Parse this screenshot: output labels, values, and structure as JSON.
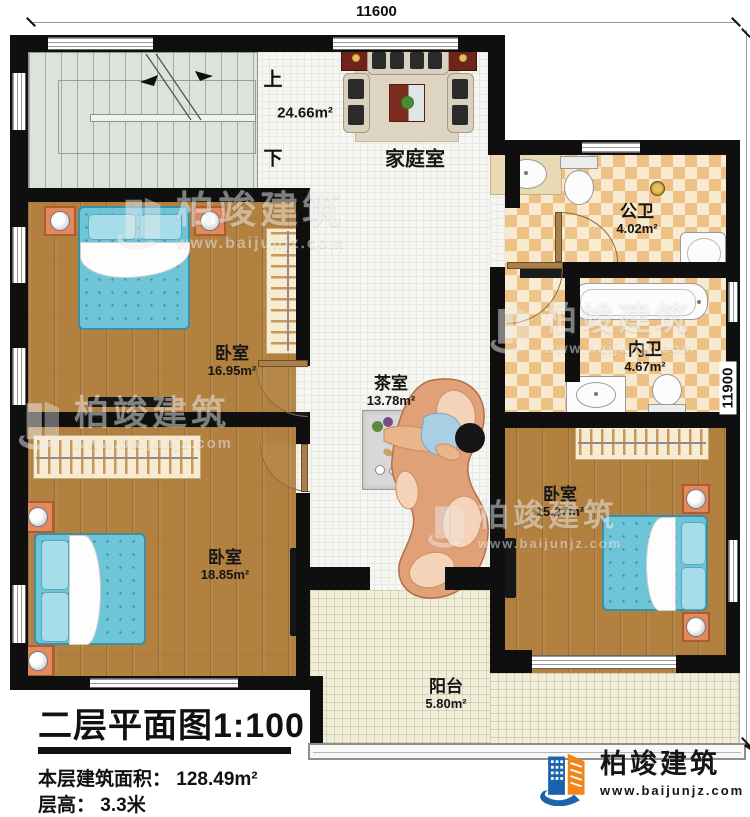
{
  "plan": {
    "dimensions": {
      "top": "11600",
      "right": "11900"
    },
    "stairs": {
      "up": "上",
      "down": "下"
    },
    "rooms": {
      "family": {
        "name": "家庭室",
        "area": "24.66m²"
      },
      "public_bath": {
        "name": "公卫",
        "area": "4.02m²"
      },
      "ensuite_bath": {
        "name": "内卫",
        "area": "4.67m²"
      },
      "bedroom1": {
        "name": "卧室",
        "area": "16.95m²"
      },
      "tea": {
        "name": "茶室",
        "area": "13.78m²"
      },
      "bedroom2": {
        "name": "卧室",
        "area": "18.85m²"
      },
      "bedroom3": {
        "name": "卧室",
        "area": "15.27m²"
      },
      "balcony": {
        "name": "阳台",
        "area": "5.80m²"
      }
    }
  },
  "title_block": {
    "title": "二层平面图",
    "scale": "1:100",
    "area_label": "本层建筑面积：",
    "area_value": "128.49m²",
    "floor_height_label": "层高：",
    "floor_height_value": "3.3米"
  },
  "logo": {
    "name": "柏竣建筑",
    "url": "www.baijunjz.com"
  },
  "watermark": {
    "text": "柏竣建筑",
    "url": "www.baijunjz.com"
  },
  "colors": {
    "wall": "#0f0f0f",
    "wood": "#b28140",
    "tile": "#f6f6f2",
    "checker": "#ecc183",
    "balcony": "#f0edd8",
    "bed": "#6fc5d8",
    "brand_blue": "#1c63ae",
    "brand_orange": "#f08519"
  }
}
